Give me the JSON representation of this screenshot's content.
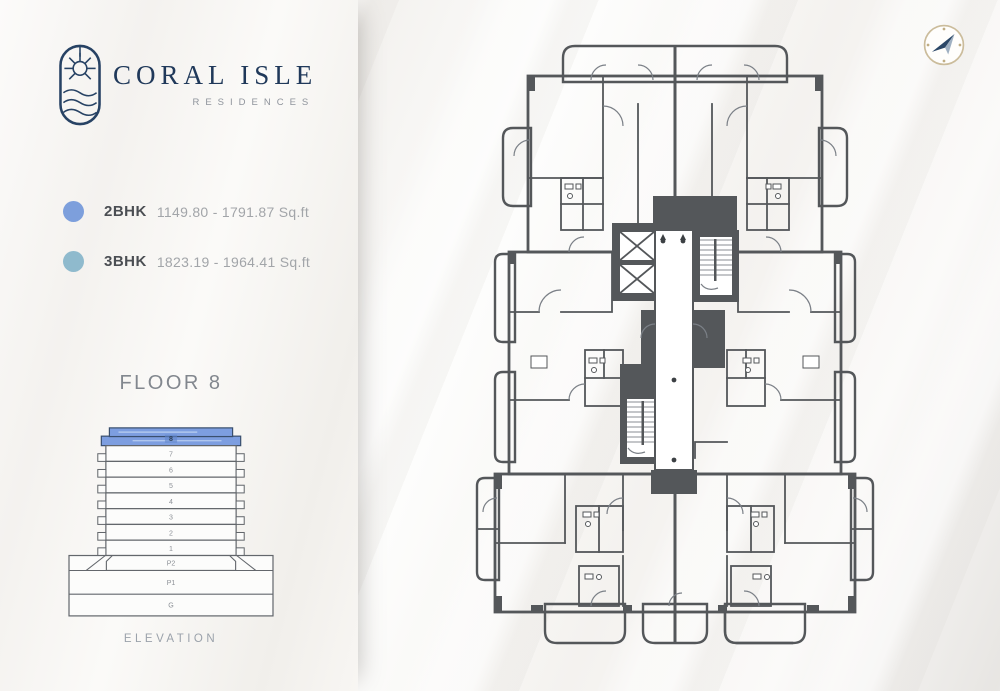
{
  "brand": {
    "name": "CORAL ISLE",
    "subtitle": "RESIDENCES"
  },
  "legend": {
    "items": [
      {
        "label": "2BHK",
        "range": "1149.80 - 1791.87 Sq.ft",
        "color": "#7d9fdc"
      },
      {
        "label": "3BHK",
        "range": "1823.19 - 1964.41 Sq.ft",
        "color": "#8fbacd"
      }
    ]
  },
  "floor": {
    "title": "FLOOR 8"
  },
  "elevation": {
    "caption": "ELEVATION",
    "highlighted_floor": "8",
    "highlight_color": "#7d9ee0",
    "floors": [
      {
        "label": "8"
      },
      {
        "label": "7"
      },
      {
        "label": "6"
      },
      {
        "label": "5"
      },
      {
        "label": "4"
      },
      {
        "label": "3"
      },
      {
        "label": "2"
      },
      {
        "label": "1"
      },
      {
        "label": "P2"
      },
      {
        "label": "P1"
      },
      {
        "label": "G"
      }
    ]
  },
  "plan": {
    "colors": {
      "unit_2bhk": "#84a2de",
      "unit_3bhk": "#a6c7da",
      "walls": "#54575a",
      "corridor": "#ffffff"
    },
    "icons": {
      "compass": "compass-icon",
      "logo_emblem": "logo-emblem-icon",
      "elevator": "elevator-x-icon",
      "stairs": "staircase-icon"
    }
  }
}
